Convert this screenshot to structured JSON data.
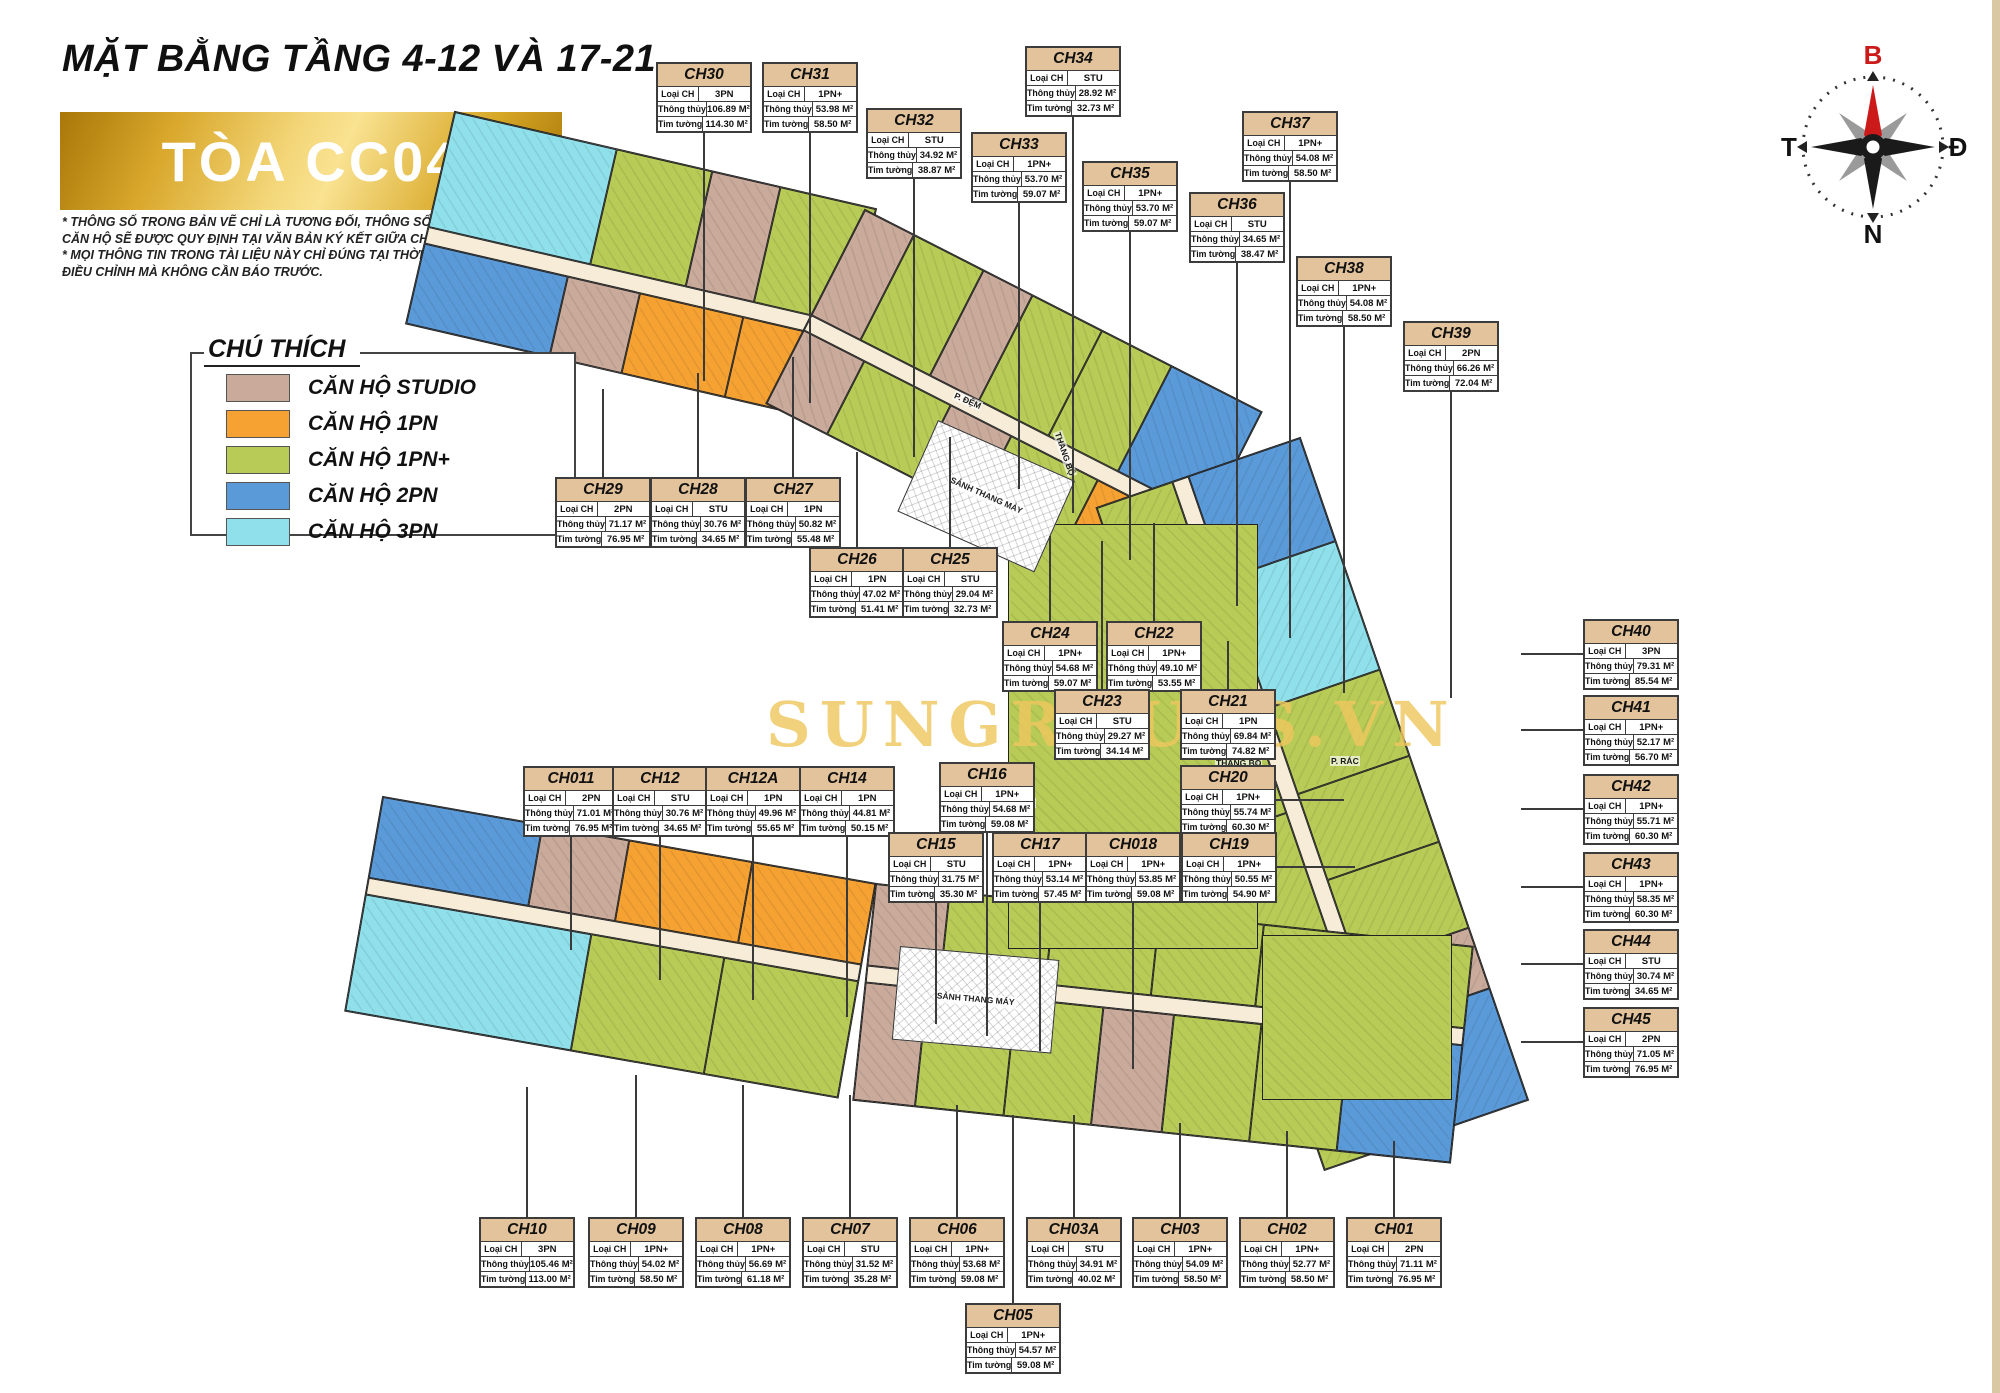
{
  "page": {
    "title": "MẶT BẰNG TẦNG 4-12 VÀ 17-21",
    "building": "TÒA CC04",
    "disclaimer1": "* THÔNG SỐ TRONG BẢN VẼ CHỈ LÀ TƯƠNG ĐỐI, THÔNG SỐ CHÍNH THỨC CỦA TỪNG CĂN HỘ SẼ ĐƯỢC QUY ĐỊNH TẠI VĂN BẢN KÝ KẾT  GIỮA CHỦ ĐẦU TƯ VÀ KHÁCH HÀNG.",
    "disclaimer2": "* MỌI THÔNG TIN TRONG TÀI LIỆU NÀY CHỈ ĐÚNG TẠI THỜI ĐIỂM PHÁT HÀNH VÀ CÓ THỂ ĐIỀU CHỈNH MÀ KHÔNG CẦN BÁO TRƯỚC.",
    "watermark": "SUNGROUPS.VN"
  },
  "legend": {
    "title": "CHÚ THÍCH",
    "items": [
      {
        "label": "CĂN HỘ STUDIO",
        "type": "STU",
        "color": "#c9aa9b"
      },
      {
        "label": "CĂN HỘ 1PN",
        "type": "1PN",
        "color": "#f6a233"
      },
      {
        "label": "CĂN HỘ 1PN+",
        "type": "1PN+",
        "color": "#b8cb56"
      },
      {
        "label": "CĂN HỘ 2PN",
        "type": "2PN",
        "color": "#5b9ad8"
      },
      {
        "label": "CĂN HỘ 3PN",
        "type": "3PN",
        "color": "#8fe0ea"
      }
    ]
  },
  "compass": {
    "north": "B",
    "east": "Đ",
    "south": "N",
    "west": "T",
    "north_color": "#cc1a1a"
  },
  "card_labels": {
    "type": "Loại CH",
    "clear": "Thông thủy",
    "wall": "Tim tường"
  },
  "units": [
    {
      "id": "CH30",
      "type": "3PN",
      "clear": "106.89 M²",
      "wall": "114.30 M²",
      "x": 656,
      "y": 62,
      "dir": "down",
      "len": 250
    },
    {
      "id": "CH31",
      "type": "1PN+",
      "clear": "53.98 M²",
      "wall": "58.50 M²",
      "x": 762,
      "y": 62,
      "dir": "down",
      "len": 272
    },
    {
      "id": "CH32",
      "type": "STU",
      "clear": "34.92 M²",
      "wall": "38.87 M²",
      "x": 866,
      "y": 108,
      "dir": "down",
      "len": 280
    },
    {
      "id": "CH33",
      "type": "1PN+",
      "clear": "53.70 M²",
      "wall": "59.07 M²",
      "x": 971,
      "y": 132,
      "dir": "down",
      "len": 288
    },
    {
      "id": "CH34",
      "type": "STU",
      "clear": "28.92 M²",
      "wall": "32.73 M²",
      "x": 1025,
      "y": 46,
      "dir": "down",
      "len": 398
    },
    {
      "id": "CH35",
      "type": "1PN+",
      "clear": "53.70 M²",
      "wall": "59.07 M²",
      "x": 1082,
      "y": 161,
      "dir": "down",
      "len": 330
    },
    {
      "id": "CH36",
      "type": "STU",
      "clear": "34.65 M²",
      "wall": "38.47 M²",
      "x": 1189,
      "y": 192,
      "dir": "down",
      "len": 345
    },
    {
      "id": "CH37",
      "type": "1PN+",
      "clear": "54.08 M²",
      "wall": "58.50 M²",
      "x": 1242,
      "y": 111,
      "dir": "down",
      "len": 458
    },
    {
      "id": "CH38",
      "type": "1PN+",
      "clear": "54.08 M²",
      "wall": "58.50 M²",
      "x": 1296,
      "y": 256,
      "dir": "down",
      "len": 368
    },
    {
      "id": "CH39",
      "type": "2PN",
      "clear": "66.26 M²",
      "wall": "72.04 M²",
      "x": 1403,
      "y": 321,
      "dir": "down",
      "len": 308
    },
    {
      "id": "CH29",
      "type": "2PN",
      "clear": "71.17 M²",
      "wall": "76.95 M²",
      "x": 555,
      "y": 477,
      "dir": "up",
      "len": 88
    },
    {
      "id": "CH28",
      "type": "STU",
      "clear": "30.76 M²",
      "wall": "34.65 M²",
      "x": 650,
      "y": 477,
      "dir": "up",
      "len": 104
    },
    {
      "id": "CH27",
      "type": "1PN",
      "clear": "50.82 M²",
      "wall": "55.48 M²",
      "x": 745,
      "y": 477,
      "dir": "up",
      "len": 120
    },
    {
      "id": "CH26",
      "type": "1PN",
      "clear": "47.02 M²",
      "wall": "51.41 M²",
      "x": 809,
      "y": 547,
      "dir": "up",
      "len": 95
    },
    {
      "id": "CH25",
      "type": "STU",
      "clear": "29.04 M²",
      "wall": "32.73 M²",
      "x": 902,
      "y": 547,
      "dir": "up",
      "len": 110
    },
    {
      "id": "CH24",
      "type": "1PN+",
      "clear": "54.68 M²",
      "wall": "59.07 M²",
      "x": 1002,
      "y": 621,
      "dir": "up",
      "len": 85
    },
    {
      "id": "CH22",
      "type": "1PN+",
      "clear": "49.10 M²",
      "wall": "53.55 M²",
      "x": 1106,
      "y": 621,
      "dir": "up",
      "len": 98
    },
    {
      "id": "CH23",
      "type": "STU",
      "clear": "29.27 M²",
      "wall": "34.14 M²",
      "x": 1054,
      "y": 689,
      "dir": "up",
      "len": 148
    },
    {
      "id": "CH21",
      "type": "1PN",
      "clear": "69.84 M²",
      "wall": "74.82 M²",
      "x": 1180,
      "y": 689,
      "dir": "up",
      "len": 48
    },
    {
      "id": "CH20",
      "type": "1PN+",
      "clear": "55.74 M²",
      "wall": "60.30 M²",
      "x": 1180,
      "y": 765,
      "dir": "right",
      "len": 70
    },
    {
      "id": "CH19",
      "type": "1PN+",
      "clear": "50.55 M²",
      "wall": "54.90 M²",
      "x": 1181,
      "y": 832,
      "dir": "right",
      "len": 80
    },
    {
      "id": "CH011",
      "type": "2PN",
      "clear": "71.01 M²",
      "wall": "76.95 M²",
      "x": 523,
      "y": 766,
      "dir": "down",
      "len": 115
    },
    {
      "id": "CH12",
      "type": "STU",
      "clear": "30.76 M²",
      "wall": "34.65 M²",
      "x": 612,
      "y": 766,
      "dir": "down",
      "len": 145
    },
    {
      "id": "CH12A",
      "type": "1PN",
      "clear": "49.96 M²",
      "wall": "55.65 M²",
      "x": 705,
      "y": 766,
      "dir": "down",
      "len": 165
    },
    {
      "id": "CH14",
      "type": "1PN",
      "clear": "44.81 M²",
      "wall": "50.15 M²",
      "x": 799,
      "y": 766,
      "dir": "down",
      "len": 182
    },
    {
      "id": "CH16",
      "type": "1PN+",
      "clear": "54.68 M²",
      "wall": "59.08 M²",
      "x": 939,
      "y": 762,
      "dir": "down",
      "len": 205
    },
    {
      "id": "CH15",
      "type": "STU",
      "clear": "31.75 M²",
      "wall": "35.30 M²",
      "x": 888,
      "y": 832,
      "dir": "down",
      "len": 123
    },
    {
      "id": "CH17",
      "type": "1PN+",
      "clear": "53.14 M²",
      "wall": "57.45 M²",
      "x": 992,
      "y": 832,
      "dir": "down",
      "len": 150
    },
    {
      "id": "CH018",
      "type": "1PN+",
      "clear": "53.85 M²",
      "wall": "59.08 M²",
      "x": 1085,
      "y": 832,
      "dir": "down",
      "len": 168
    },
    {
      "id": "CH10",
      "type": "3PN",
      "clear": "105.46 M²",
      "wall": "113.00 M²",
      "x": 479,
      "y": 1217,
      "dir": "up",
      "len": 130
    },
    {
      "id": "CH09",
      "type": "1PN+",
      "clear": "54.02 M²",
      "wall": "58.50 M²",
      "x": 588,
      "y": 1217,
      "dir": "up",
      "len": 142
    },
    {
      "id": "CH08",
      "type": "1PN+",
      "clear": "56.69 M²",
      "wall": "61.18 M²",
      "x": 695,
      "y": 1217,
      "dir": "up",
      "len": 132
    },
    {
      "id": "CH07",
      "type": "STU",
      "clear": "31.52 M²",
      "wall": "35.28 M²",
      "x": 802,
      "y": 1217,
      "dir": "up",
      "len": 122
    },
    {
      "id": "CH06",
      "type": "1PN+",
      "clear": "53.68 M²",
      "wall": "59.08 M²",
      "x": 909,
      "y": 1217,
      "dir": "up",
      "len": 112
    },
    {
      "id": "CH03A",
      "type": "STU",
      "clear": "34.91 M²",
      "wall": "40.02 M²",
      "x": 1026,
      "y": 1217,
      "dir": "up",
      "len": 102
    },
    {
      "id": "CH03",
      "type": "1PN+",
      "clear": "54.09 M²",
      "wall": "58.50 M²",
      "x": 1132,
      "y": 1217,
      "dir": "up",
      "len": 94
    },
    {
      "id": "CH02",
      "type": "1PN+",
      "clear": "52.77 M²",
      "wall": "58.50 M²",
      "x": 1239,
      "y": 1217,
      "dir": "up",
      "len": 86
    },
    {
      "id": "CH01",
      "type": "2PN",
      "clear": "71.11 M²",
      "wall": "76.95 M²",
      "x": 1346,
      "y": 1217,
      "dir": "up",
      "len": 76
    },
    {
      "id": "CH05",
      "type": "1PN+",
      "clear": "54.57 M²",
      "wall": "59.08 M²",
      "x": 965,
      "y": 1303,
      "dir": "up",
      "len": 188
    },
    {
      "id": "CH40",
      "type": "3PN",
      "clear": "79.31 M²",
      "wall": "85.54 M²",
      "x": 1583,
      "y": 619,
      "dir": "left",
      "len": 62
    },
    {
      "id": "CH41",
      "type": "1PN+",
      "clear": "52.17 M²",
      "wall": "56.70 M²",
      "x": 1583,
      "y": 695,
      "dir": "left",
      "len": 62
    },
    {
      "id": "CH42",
      "type": "1PN+",
      "clear": "55.71 M²",
      "wall": "60.30 M²",
      "x": 1583,
      "y": 774,
      "dir": "left",
      "len": 62
    },
    {
      "id": "CH43",
      "type": "1PN+",
      "clear": "58.35 M²",
      "wall": "60.30 M²",
      "x": 1583,
      "y": 852,
      "dir": "left",
      "len": 62
    },
    {
      "id": "CH44",
      "type": "STU",
      "clear": "30.74 M²",
      "wall": "34.65 M²",
      "x": 1583,
      "y": 929,
      "dir": "left",
      "len": 62
    },
    {
      "id": "CH45",
      "type": "2PN",
      "clear": "71.05 M²",
      "wall": "76.95 M²",
      "x": 1583,
      "y": 1007,
      "dir": "left",
      "len": 62
    }
  ],
  "plan": {
    "corridor_color": "#f6ecd8",
    "wings": [
      {
        "x": 455,
        "y": 112,
        "w": 432,
        "rot": 13,
        "rows": [
          {
            "kind": "units",
            "h": 118,
            "cells": [
              {
                "t": "3PN",
                "f": 1.7
              },
              {
                "t": "1PN+",
                "f": 1
              },
              {
                "t": "STU",
                "f": 0.7
              },
              {
                "t": "1PN+",
                "f": 1
              }
            ]
          },
          {
            "kind": "corridor",
            "h": 17
          },
          {
            "kind": "units",
            "h": 82,
            "cells": [
              {
                "t": "2PN",
                "f": 1.4
              },
              {
                "t": "STU",
                "f": 0.7
              },
              {
                "t": "1PN",
                "f": 1
              },
              {
                "t": "1PN",
                "f": 1
              }
            ]
          }
        ]
      },
      {
        "x": 865,
        "y": 210,
        "w": 445,
        "rot": 27,
        "rows": [
          {
            "kind": "units",
            "h": 118,
            "cells": [
              {
                "t": "STU",
                "f": 0.7
              },
              {
                "t": "1PN+",
                "f": 1
              },
              {
                "t": "STU",
                "f": 0.7
              },
              {
                "t": "1PN+",
                "f": 1
              },
              {
                "t": "1PN+",
                "f": 1
              },
              {
                "t": "2PN",
                "f": 1.3
              }
            ]
          },
          {
            "kind": "corridor",
            "h": 17
          },
          {
            "kind": "units",
            "h": 82,
            "cells": [
              {
                "t": "STU",
                "f": 0.7
              },
              {
                "t": "1PN+",
                "f": 1
              },
              {
                "t": "STU",
                "f": 0.7
              },
              {
                "t": "1PN+",
                "f": 1
              },
              {
                "t": "1PN",
                "f": 1.2
              }
            ]
          }
        ]
      },
      {
        "x": 1300,
        "y": 438,
        "w": 700,
        "rot": 71,
        "rows": [
          {
            "kind": "units",
            "h": 118,
            "cells": [
              {
                "t": "2PN",
                "f": 1.2
              },
              {
                "t": "3PN",
                "f": 1.5
              },
              {
                "t": "1PN+",
                "f": 1
              },
              {
                "t": "1PN+",
                "f": 1
              },
              {
                "t": "1PN+",
                "f": 1
              },
              {
                "t": "STU",
                "f": 0.7
              },
              {
                "t": "2PN",
                "f": 1.3
              }
            ]
          },
          {
            "kind": "corridor",
            "h": 17
          },
          {
            "kind": "units",
            "h": 80,
            "cells": [
              {
                "t": "1PN+",
                "f": 1
              },
              {
                "t": "1PN+",
                "f": 1
              },
              {
                "t": "1PN+",
                "f": 1
              },
              {
                "t": "1PN+",
                "f": 1
              }
            ]
          }
        ]
      },
      {
        "x": 383,
        "y": 797,
        "w": 500,
        "rot": 10,
        "rows": [
          {
            "kind": "units",
            "h": 82,
            "cells": [
              {
                "t": "2PN",
                "f": 1.3
              },
              {
                "t": "STU",
                "f": 0.7
              },
              {
                "t": "1PN",
                "f": 1
              },
              {
                "t": "1PN",
                "f": 1
              }
            ]
          },
          {
            "kind": "corridor",
            "h": 17
          },
          {
            "kind": "units",
            "h": 118,
            "cells": [
              {
                "t": "3PN",
                "f": 1.7
              },
              {
                "t": "1PN+",
                "f": 1
              },
              {
                "t": "1PN+",
                "f": 1
              }
            ]
          }
        ]
      },
      {
        "x": 876,
        "y": 884,
        "w": 600,
        "rot": 6,
        "rows": [
          {
            "kind": "units",
            "h": 82,
            "cells": [
              {
                "t": "STU",
                "f": 0.7
              },
              {
                "t": "1PN+",
                "f": 1
              },
              {
                "t": "1PN+",
                "f": 1
              },
              {
                "t": "1PN+",
                "f": 1
              },
              {
                "t": "1PN+",
                "f": 1
              },
              {
                "t": "1PN+",
                "f": 1
              }
            ]
          },
          {
            "kind": "corridor",
            "h": 17
          },
          {
            "kind": "units",
            "h": 118,
            "cells": [
              {
                "t": "STU",
                "f": 0.7
              },
              {
                "t": "1PN+",
                "f": 1
              },
              {
                "t": "1PN+",
                "f": 1
              },
              {
                "t": "STU",
                "f": 0.8
              },
              {
                "t": "1PN+",
                "f": 1
              },
              {
                "t": "1PN+",
                "f": 1
              },
              {
                "t": "2PN",
                "f": 1.3
              }
            ]
          }
        ]
      }
    ],
    "blocks": [
      {
        "t": "1PN+",
        "x": 1008,
        "y": 524,
        "w": 250,
        "h": 425
      },
      {
        "t": "1PN+",
        "x": 1262,
        "y": 935,
        "w": 190,
        "h": 165
      }
    ],
    "cores": [
      {
        "x": 938,
        "y": 420,
        "w": 148,
        "h": 98,
        "rot": 24,
        "label": "SẢNH THANG MÁY"
      },
      {
        "x": 900,
        "y": 946,
        "w": 158,
        "h": 92,
        "rot": 5,
        "label": "SẢNH THANG MÁY"
      }
    ],
    "labels": [
      {
        "text": "THANG BỘ",
        "x": 1215,
        "y": 758,
        "rot": 0
      },
      {
        "text": "P. RÁC",
        "x": 1330,
        "y": 756,
        "rot": 0
      },
      {
        "text": "P. ĐỆM",
        "x": 1006,
        "y": 798,
        "rot": 0
      },
      {
        "text": "P. ĐỆM",
        "x": 956,
        "y": 390,
        "rot": 24
      },
      {
        "text": "THANG BỘ",
        "x": 1062,
        "y": 430,
        "rot": 71
      }
    ]
  }
}
